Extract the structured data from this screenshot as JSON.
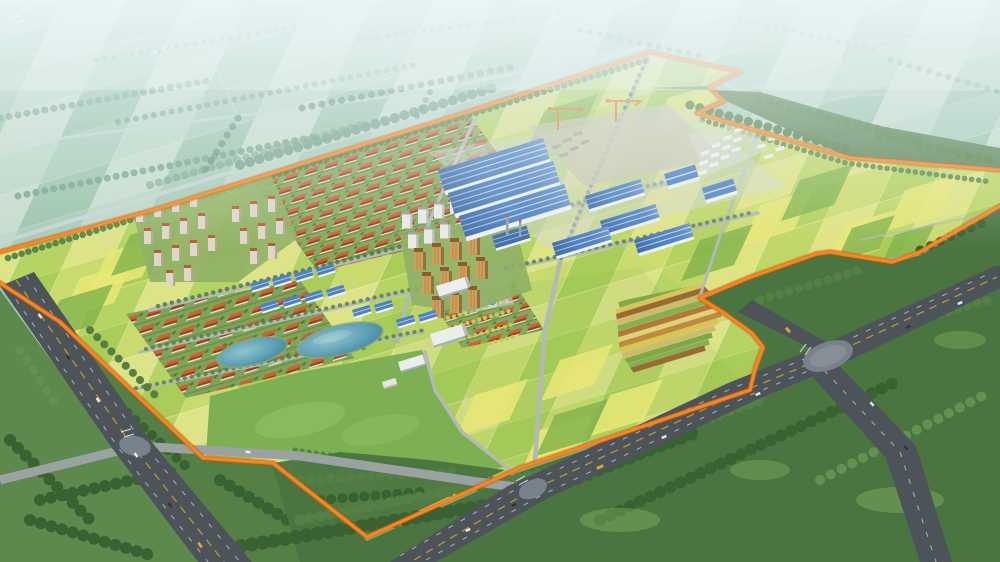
{
  "scene": {
    "type": "aerial-masterplan-rendering",
    "setting": "peri-urban farmland with planned town site",
    "boundary_color": "#ee7a18"
  },
  "palette": {
    "bg_top": "#d8e9ec",
    "bg_mid": "#aecfc0",
    "bg_low": "#8cb878",
    "haze": "#ecf6f8",
    "distant_a": "#a9cbb6",
    "distant_b": "#bdd8c5",
    "distant_c": "#9cc3ab",
    "distant_d": "#c8ddcd",
    "distant_tree": "#74a084",
    "distant_tree_dark": "#5e8d72",
    "distant_road": "#c9d6d3",
    "distant_bldg": "#e7eef0",
    "field_a": "#c9db6e",
    "field_b": "#a9cd58",
    "field_c": "#dde387",
    "field_d": "#b6d463",
    "field_bright": "#e9e776",
    "field_dark": "#7fb24b",
    "field_line": "#eef0c8",
    "lawn": "#7cb052",
    "lawn_light": "#96c46a",
    "forest": "#4a7440",
    "forest_dark": "#3a6132",
    "forest_mid": "#547f45",
    "forest_light": "#639150",
    "hedge": "#4c7a40",
    "tree_row": "#4f7d41",
    "boundary": "#ee7a18",
    "boundary_dark": "#b5520c",
    "boundary_light": "#ffa040",
    "road_minor": "#9aa3a1",
    "road_inner": "#b2bab6",
    "asphalt": "#4d5459",
    "asphalt_pad": "#78828a",
    "lane_yellow": "#d2a832",
    "lane_white": "#dfe4e4",
    "pond_deep": "#2f7d9e",
    "pond_mid": "#5fa0b4",
    "pond_light": "#8ec4cd",
    "pond_edge": "#8fae72",
    "village_yard": "#87a95c",
    "villa_yard": "#7fa457",
    "roof_light": "#cd6134",
    "roof_dark": "#9a3f1e",
    "wall": "#ece5d2",
    "roof_blue": "#4d81c3",
    "roof_blue_dark": "#3f6ea8",
    "ridge": "#dce9f6",
    "wall_light": "#edf1f6",
    "pad_gray": "#d3d7cf",
    "yard_gray": "#c9c4b2",
    "stack": "#b3a88f",
    "beige": "#ded7c8",
    "beige_side": "#b4a892",
    "beige_roof": "#b85c34",
    "amber": "#cfa05c",
    "amber_side": "#94703c",
    "amber_roof": "#8a5c2e",
    "white_b": "#e9e9e6",
    "white_side": "#bfc3c4",
    "white_roof": "#9aa0a4",
    "inst": "#eceeea",
    "inst_side": "#b9bdb9",
    "crane": "#e87c22",
    "chimney": "#98a0a6",
    "st1": "#c08a3e",
    "st2": "#7da94a",
    "st3": "#d9c557",
    "st4": "#9a6a33",
    "st5": "#cdbb6e",
    "st6": "#86b052",
    "st7": "#b5763a",
    "st8": "#e0d27c",
    "bush": "#c3cc57",
    "car_white": "#e9eaea",
    "car_dark": "#2e3438",
    "car_yellow": "#e0a62a"
  },
  "features": {
    "site_boundary": {
      "style": "solid orange outline",
      "color_ref": "boundary"
    },
    "zones": [
      {
        "id": "industrial-park",
        "roof_color_ref": "roof_blue",
        "tower_cranes": 2,
        "chimneys": 2
      },
      {
        "id": "village-neighborhood",
        "roof_color_ref": "roof_light"
      },
      {
        "id": "villa-neighborhood",
        "roof_color_ref": "roof_light"
      },
      {
        "id": "apartment-clusters",
        "facade_color_refs": [
          "beige",
          "amber",
          "white_b"
        ]
      },
      {
        "id": "farm-fields",
        "color_refs": [
          "field_a",
          "field_b",
          "field_c",
          "field_d"
        ]
      },
      {
        "id": "experimental-crop-strips",
        "color_refs": [
          "st1",
          "st2",
          "st3",
          "st4",
          "st5",
          "st6",
          "st7",
          "st8"
        ]
      },
      {
        "id": "central-lawn",
        "color_ref": "lawn"
      },
      {
        "id": "ponds",
        "count": 2
      },
      {
        "id": "water-tanks",
        "count": 3
      },
      {
        "id": "peripheral-forest",
        "color_ref": "forest"
      },
      {
        "id": "highways",
        "count": 2
      },
      {
        "id": "road-intersections",
        "count": 3
      }
    ],
    "vehicles": {
      "cars": 14,
      "buses": 3
    }
  }
}
